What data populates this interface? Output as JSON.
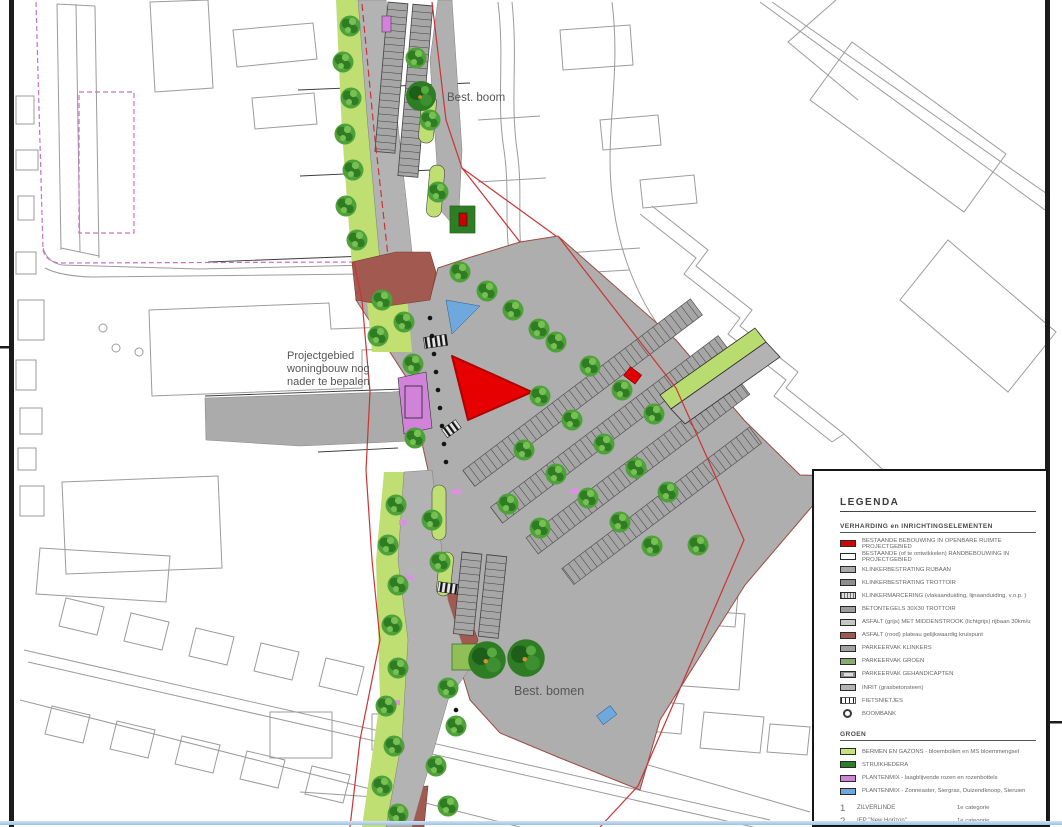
{
  "map": {
    "labels": {
      "best_boom": "Best. boom",
      "best_bomen": "Best. bomen",
      "projectgebied_lines": [
        "Projectgebied",
        "woningbouw nog",
        "nader te bepalen"
      ]
    },
    "colors": {
      "existing_building_red": "#e60000",
      "asfalt_rood_plateau": "#a2594f",
      "berm_green": "#bfdf72",
      "tree_green": "#4fa23a",
      "existing_tree_green": "#2e7d25",
      "plantenmix_paars": "#d083d8",
      "plantenmix_blauw": "#6fa8dc",
      "pavement_gray": "#aeaeae",
      "project_boundary_red": "#cc3333",
      "cadastral_magenta": "#c76fc9"
    }
  },
  "legend": {
    "title": "LEGENDA",
    "sections": [
      {
        "heading": "VERHARDING en INRICHTINGSELEMENTEN",
        "items": [
          {
            "swatch": "sw-red",
            "label": "BESTAANDE BEBOUWING IN OPENBARE RUIMTE PROJECTGEBIED"
          },
          {
            "swatch": "sw-white",
            "label": "BESTAANDE (of te ontwikkelen) RANDBEBOUWING IN PROJECTGEBIED"
          },
          {
            "swatch": "sw-klinker-rijbaan",
            "label": "KLINKERBESTRATING RIJBAAN"
          },
          {
            "swatch": "sw-klinker-trottoir",
            "label": "KLINKERBESTRATING TROTTOIR"
          },
          {
            "swatch": "sw-klinkermarcering",
            "label": "KLINKERMARCERING (vlakaanduiding, lijnaanduiding, v.o.p. )"
          },
          {
            "swatch": "sw-betontegels",
            "label": "BETONTEGELS 30X30 TROTTOIR"
          },
          {
            "swatch": "sw-asfalt-grijs",
            "label": "ASFALT (grijs) MET MIDDENSTROOK (lichtgrijs) rijbaan 30km/u"
          },
          {
            "swatch": "sw-asfalt-rood",
            "label": "ASFALT (rood) plateau gelijkwaardig kruispunt"
          },
          {
            "swatch": "sw-parkeer-klinkers",
            "label": "PARKEERVAK KLINKERS"
          },
          {
            "swatch": "sw-parkeer-groen",
            "label": "PARKEERVAK GROEN"
          },
          {
            "swatch": "sw-parkeer-gehandicapten",
            "label": "PARKEERVAK GEHANDICAPTEN"
          },
          {
            "swatch": "sw-inrit",
            "label": "INRIT (grasbetonsteen)"
          },
          {
            "swatch": "sw-fietsnietjes",
            "label": "FIETSNIETJES"
          },
          {
            "swatch": "sw-boombank",
            "label": "BOOMBANK"
          }
        ]
      },
      {
        "heading": "GROEN",
        "items": [
          {
            "swatch": "sw-bermen",
            "label": "BERMEN EN GAZONS - bloembollen en MS bloemmengsel"
          },
          {
            "swatch": "sw-struikhedera",
            "label": "STRUIKHEDERA"
          },
          {
            "swatch": "sw-plantenmix-paars",
            "label": "PLANTENMIX - laagblijvende rozen en rozenbottels"
          },
          {
            "swatch": "sw-plantenmix-blauw",
            "label": "PLANTENMIX - Zonneaster, Siergras, Duizendknoop, Sieruien"
          }
        ]
      }
    ],
    "trees": [
      {
        "num": "1",
        "name": "ZILVERLINDE",
        "category": "1e categorie"
      },
      {
        "num": "2",
        "name": "IEP \"New Horizon\"",
        "category": "1e categorie"
      },
      {
        "num": "3",
        "name": "LINDE \"Hoogeind Select\"",
        "category": "2e categorie"
      },
      {
        "num": "4",
        "name": "SIERKERS \"Plena\"",
        "category": "2e categorie"
      }
    ]
  }
}
